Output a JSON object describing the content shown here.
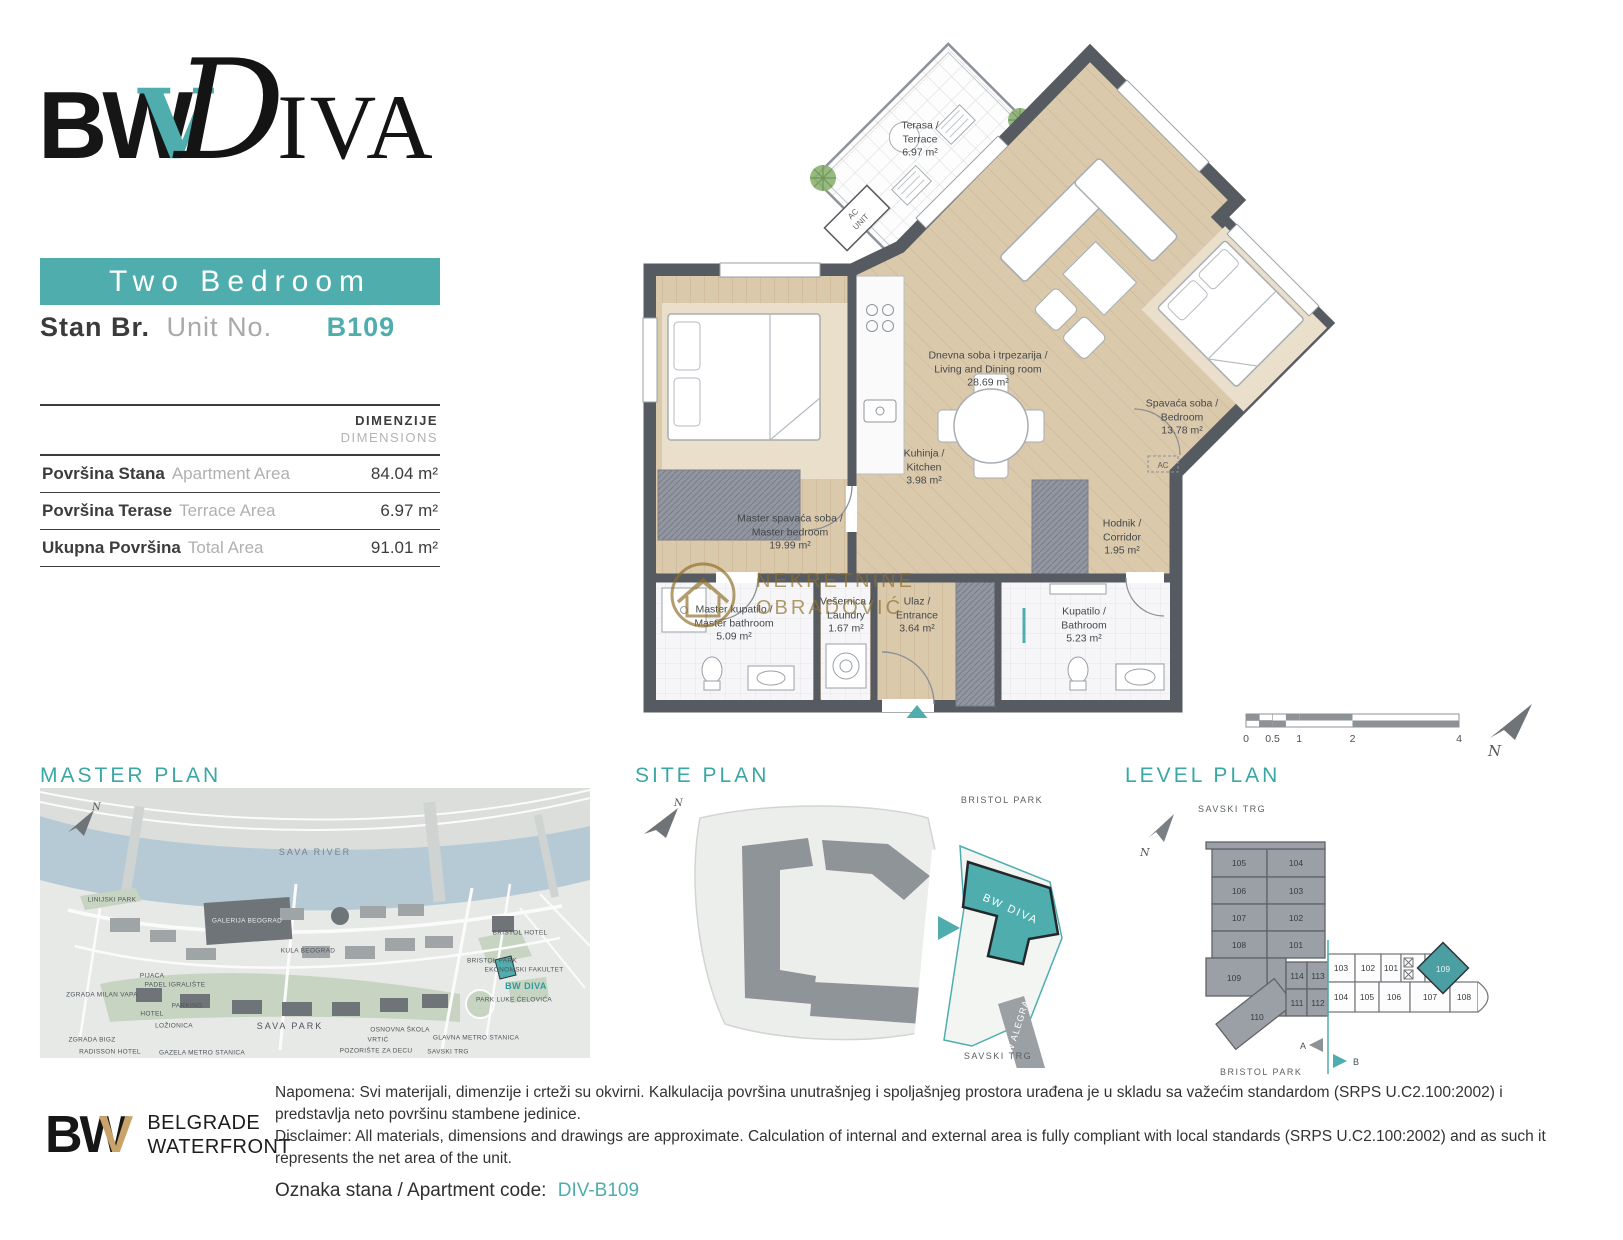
{
  "brand": {
    "bw": "BW",
    "v": "V",
    "d": "D",
    "iva": "IVA"
  },
  "header": {
    "unit_type": "Two Bedroom",
    "unit_label_sr": "Stan Br.",
    "unit_label_en": "Unit No.",
    "unit_number": "B109"
  },
  "dimensions": {
    "title_sr": "DIMENZIJE",
    "title_en": "DIMENSIONS",
    "rows": [
      {
        "label_sr": "Površina Stana",
        "label_en": "Apartment Area",
        "value": "84.04 m²"
      },
      {
        "label_sr": "Površina Terase",
        "label_en": "Terrace Area",
        "value": "6.97 m²"
      },
      {
        "label_sr": "Ukupna Površina",
        "label_en": "Total Area",
        "value": "91.01 m²"
      }
    ]
  },
  "floor_plan": {
    "rooms": [
      {
        "name_sr": "Terasa /",
        "name_en": "Terrace",
        "area": "6.97 m²"
      },
      {
        "name_sr": "Dnevna soba i trpezarija /",
        "name_en": "Living and Dining room",
        "area": "28.69 m²"
      },
      {
        "name_sr": "Kuhinja /",
        "name_en": "Kitchen",
        "area": "3.98 m²"
      },
      {
        "name_sr": "Spavaća soba /",
        "name_en": "Bedroom",
        "area": "13.78 m²"
      },
      {
        "name_sr": "Hodnik /",
        "name_en": "Corridor",
        "area": "1.95 m²"
      },
      {
        "name_sr": "Master spavaća soba /",
        "name_en": "Master bedroom",
        "area": "19.99 m²"
      },
      {
        "name_sr": "Master kupatilo /",
        "name_en": "Master bathroom",
        "area": "5.09 m²"
      },
      {
        "name_sr": "Vešernica /",
        "name_en": "Laundry",
        "area": "1.67 m²"
      },
      {
        "name_sr": "Ulaz /",
        "name_en": "Entrance",
        "area": "3.64 m²"
      },
      {
        "name_sr": "Kupatilo /",
        "name_en": "Bathroom",
        "area": "5.23 m²"
      }
    ],
    "ac_unit_line1": "AC",
    "ac_unit_line2": "UNIT",
    "ac_small": "AC",
    "watermark_line1": "NEKRETNINE",
    "watermark_line2": "OBRADOVIĆ"
  },
  "compass": {
    "label": "N"
  },
  "scale_bar": {
    "ticks": [
      "0",
      "0.5",
      "1",
      "2",
      "4"
    ]
  },
  "master_plan": {
    "title": "MASTER PLAN",
    "labels": [
      "SAVA RIVER",
      "LINIJSKI PARK",
      "GALERIJA BEOGRAD",
      "KULA BEOGRAD",
      "PIJACA",
      "PADEL IGRALIŠTE",
      "ZGRADA MILAN VAPA",
      "PARKING",
      "HOTEL",
      "LOŽIONICA",
      "SAVA PARK",
      "ZGRADA BIGZ",
      "RADISSON HOTEL",
      "GAZELA METRO STANICA",
      "OSNOVNA ŠKOLA",
      "VRTIĆ",
      "POZORIŠTE ZA DECU",
      "GLAVNA METRO STANICA",
      "SAVSKI TRG",
      "BRISTOL PARK",
      "BRISTOL HOTEL",
      "EKONOMSKI FAKULTET",
      "BW DIVA",
      "PARK LUKE ĆELOVIĆA"
    ]
  },
  "site_plan": {
    "title": "SITE PLAN",
    "park_label": "BRISTOL PARK",
    "square_label": "SAVSKI TRG",
    "building_label": "BW DIVA",
    "neighbor_label": "BW ALEGRA"
  },
  "level_plan": {
    "title": "LEVEL PLAN",
    "top_label": "SAVSKI TRG",
    "bottom_label": "BRISTOL PARK",
    "marker_a": "A",
    "marker_b": "B",
    "left_wing": [
      "105",
      "104",
      "106",
      "103",
      "107",
      "102",
      "108",
      "101",
      "109",
      "110",
      "114",
      "113",
      "111",
      "112"
    ],
    "right_wing_top": [
      "103",
      "102",
      "101"
    ],
    "right_wing_unit": "109",
    "right_wing_bottom": [
      "104",
      "105",
      "106",
      "107",
      "108"
    ]
  },
  "footer": {
    "logo_bw": "BW",
    "logo_v": "V",
    "logo_line1": "BELGRADE",
    "logo_line2": "WATERFRONT",
    "note_sr": "Napomena: Svi materijali, dimenzije i crteži su okvirni. Kalkulacija površina unutrašnjeg i spoljašnjeg prostora urađena je u skladu sa važećim standardom (SRPS U.C2.100:2002) i predstavlja neto površinu stambene jedinice.",
    "note_en": "Disclaimer: All materials, dimensions and drawings are approximate. Calculation of internal and external area is fully compliant with local standards (SRPS U.C2.100:2002) and as such it represents the net area of the unit.",
    "code_label": "Oznaka stana / Apartment code:",
    "code_value": "DIV-B109"
  },
  "colors": {
    "teal": "#4fadae",
    "wall": "#565b61",
    "floor": "#dbc9ac",
    "gold": "#c9a36a",
    "watermark_gold": "#8f6f2a",
    "river": "#b6cad5"
  }
}
